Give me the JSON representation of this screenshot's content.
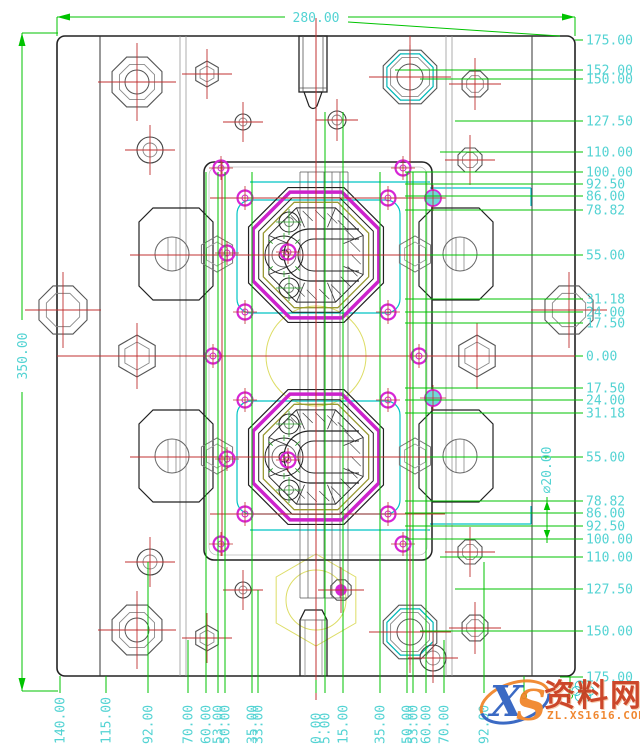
{
  "drawing": {
    "dim_top": "280.00",
    "dim_left": "350.00",
    "dim_diameter": "∅20.00",
    "right_dims": [
      {
        "v": "175.00",
        "y": 40,
        "x1": 575
      },
      {
        "v": "152.00",
        "y": 70,
        "x1": 395
      },
      {
        "v": "150.00",
        "y": 79,
        "x1": 420
      },
      {
        "v": "127.50",
        "y": 121,
        "x1": 455
      },
      {
        "v": "110.00",
        "y": 152,
        "x1": 440
      },
      {
        "v": "100.00",
        "y": 172,
        "x1": 405
      },
      {
        "v": "92.50",
        "y": 184,
        "x1": 405
      },
      {
        "v": "86.00",
        "y": 196,
        "x1": 405
      },
      {
        "v": "78.82",
        "y": 210,
        "x1": 405
      },
      {
        "v": "55.00",
        "y": 255,
        "x1": 430
      },
      {
        "v": "31.18",
        "y": 299,
        "x1": 405
      },
      {
        "v": "24.00",
        "y": 312,
        "x1": 405
      },
      {
        "v": "17.50",
        "y": 323,
        "x1": 405
      },
      {
        "v": "0.00",
        "y": 356,
        "x1": 575
      },
      {
        "v": "17.50",
        "y": 388,
        "x1": 405
      },
      {
        "v": "24.00",
        "y": 400,
        "x1": 405
      },
      {
        "v": "31.18",
        "y": 413,
        "x1": 405
      },
      {
        "v": "55.00",
        "y": 457,
        "x1": 430
      },
      {
        "v": "78.82",
        "y": 501,
        "x1": 405
      },
      {
        "v": "86.00",
        "y": 513,
        "x1": 405
      },
      {
        "v": "92.50",
        "y": 526,
        "x1": 405
      },
      {
        "v": "100.00",
        "y": 539,
        "x1": 405
      },
      {
        "v": "110.00",
        "y": 557,
        "x1": 440
      },
      {
        "v": "127.50",
        "y": 589,
        "x1": 455
      },
      {
        "v": "150.00",
        "y": 631,
        "x1": 420
      },
      {
        "v": "175.00",
        "y": 677,
        "x1": 560
      }
    ],
    "bottom_dims": [
      {
        "v": "140.00",
        "x": 60,
        "t": 676
      },
      {
        "v": "115.00",
        "x": 106,
        "t": 676
      },
      {
        "v": "92.00",
        "x": 148,
        "t": 562
      },
      {
        "v": "70.00",
        "x": 188,
        "t": 640
      },
      {
        "v": "60.00",
        "x": 206,
        "t": 172
      },
      {
        "v": "53.00",
        "x": 218,
        "t": 172
      },
      {
        "v": "50.00",
        "x": 225,
        "t": 172
      },
      {
        "v": "35.00",
        "x": 252,
        "t": 172
      },
      {
        "v": "33.00",
        "x": 258,
        "t": 590
      },
      {
        "v": "0.00",
        "x": 316,
        "t": 680
      },
      {
        "v": "5.00",
        "x": 325,
        "t": 112
      },
      {
        "v": "15.00",
        "x": 343,
        "t": 112
      },
      {
        "v": "35.00",
        "x": 380,
        "t": 172
      },
      {
        "v": "50.00",
        "x": 407,
        "t": 172
      },
      {
        "v": "53.00",
        "x": 413,
        "t": 172
      },
      {
        "v": "60.00",
        "x": 426,
        "t": 172
      },
      {
        "v": "70.00",
        "x": 444,
        "t": 640
      },
      {
        "v": "92.00",
        "x": 484,
        "t": 562
      },
      {
        "v": "",
        "x": 524,
        "t": 676
      },
      {
        "v": "",
        "x": 570,
        "t": 676
      }
    ],
    "colors": {
      "dim_line": "#00c300",
      "dim_text": "#53d3d3",
      "centerline": "#c03030",
      "geometry": "#222222",
      "cooling": "#00c4c4",
      "ejector": "#d626d6",
      "insert_ring": "#999933",
      "reference": "#dddd66"
    }
  },
  "watermark": {
    "logo_x": "X",
    "logo_s": "S",
    "site_name": "资料网",
    "site_url": "ZL.XS1616.COM"
  }
}
